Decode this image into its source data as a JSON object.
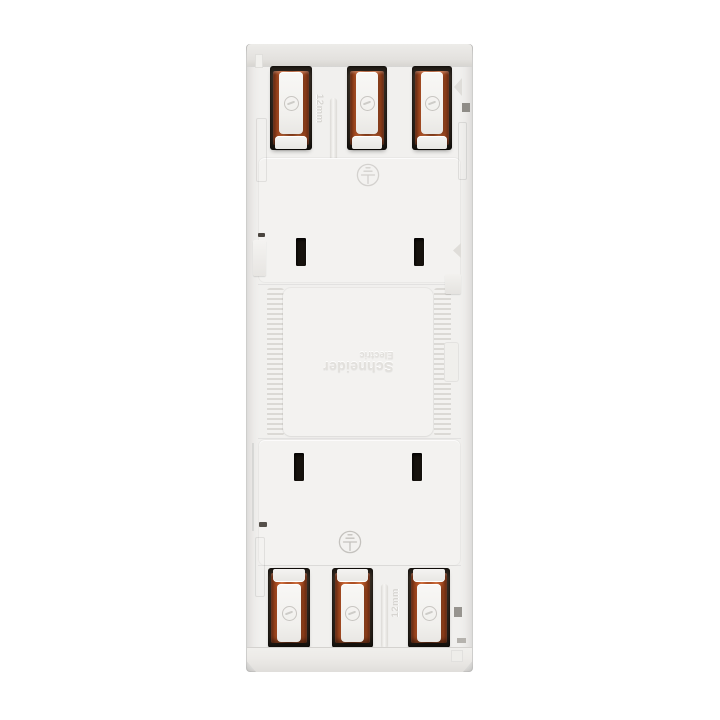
{
  "image": {
    "type": "product-photo",
    "subject": "Rear view of a Schneider Electric modular DIN-rail device, shown rotated 180 degrees",
    "background_color": "#ffffff"
  },
  "device": {
    "brand": {
      "line1": "Schneider",
      "line2": "Electric"
    },
    "labels": {
      "top_wire_gauge": "12mm",
      "bottom_wire_gauge": "12mm"
    },
    "top_terminal_count": 3,
    "bottom_terminal_count": 3,
    "icons": {
      "earth_top": "protective-earth",
      "earth_bottom": "protective-earth",
      "lever_glyph": "screwdriver-slot"
    },
    "colors": {
      "body": "#f1f0ee",
      "panel": "#f3f2f0",
      "rib": "#dbd9d5",
      "copper": "#b05226",
      "copper_dark": "#6e2a0e",
      "copper_light": "#cf7040",
      "slot": "#17130e",
      "emboss": "#e2e0dc",
      "emboss_text": "#d7d5d1",
      "symbol": "#a8a5a0"
    }
  }
}
